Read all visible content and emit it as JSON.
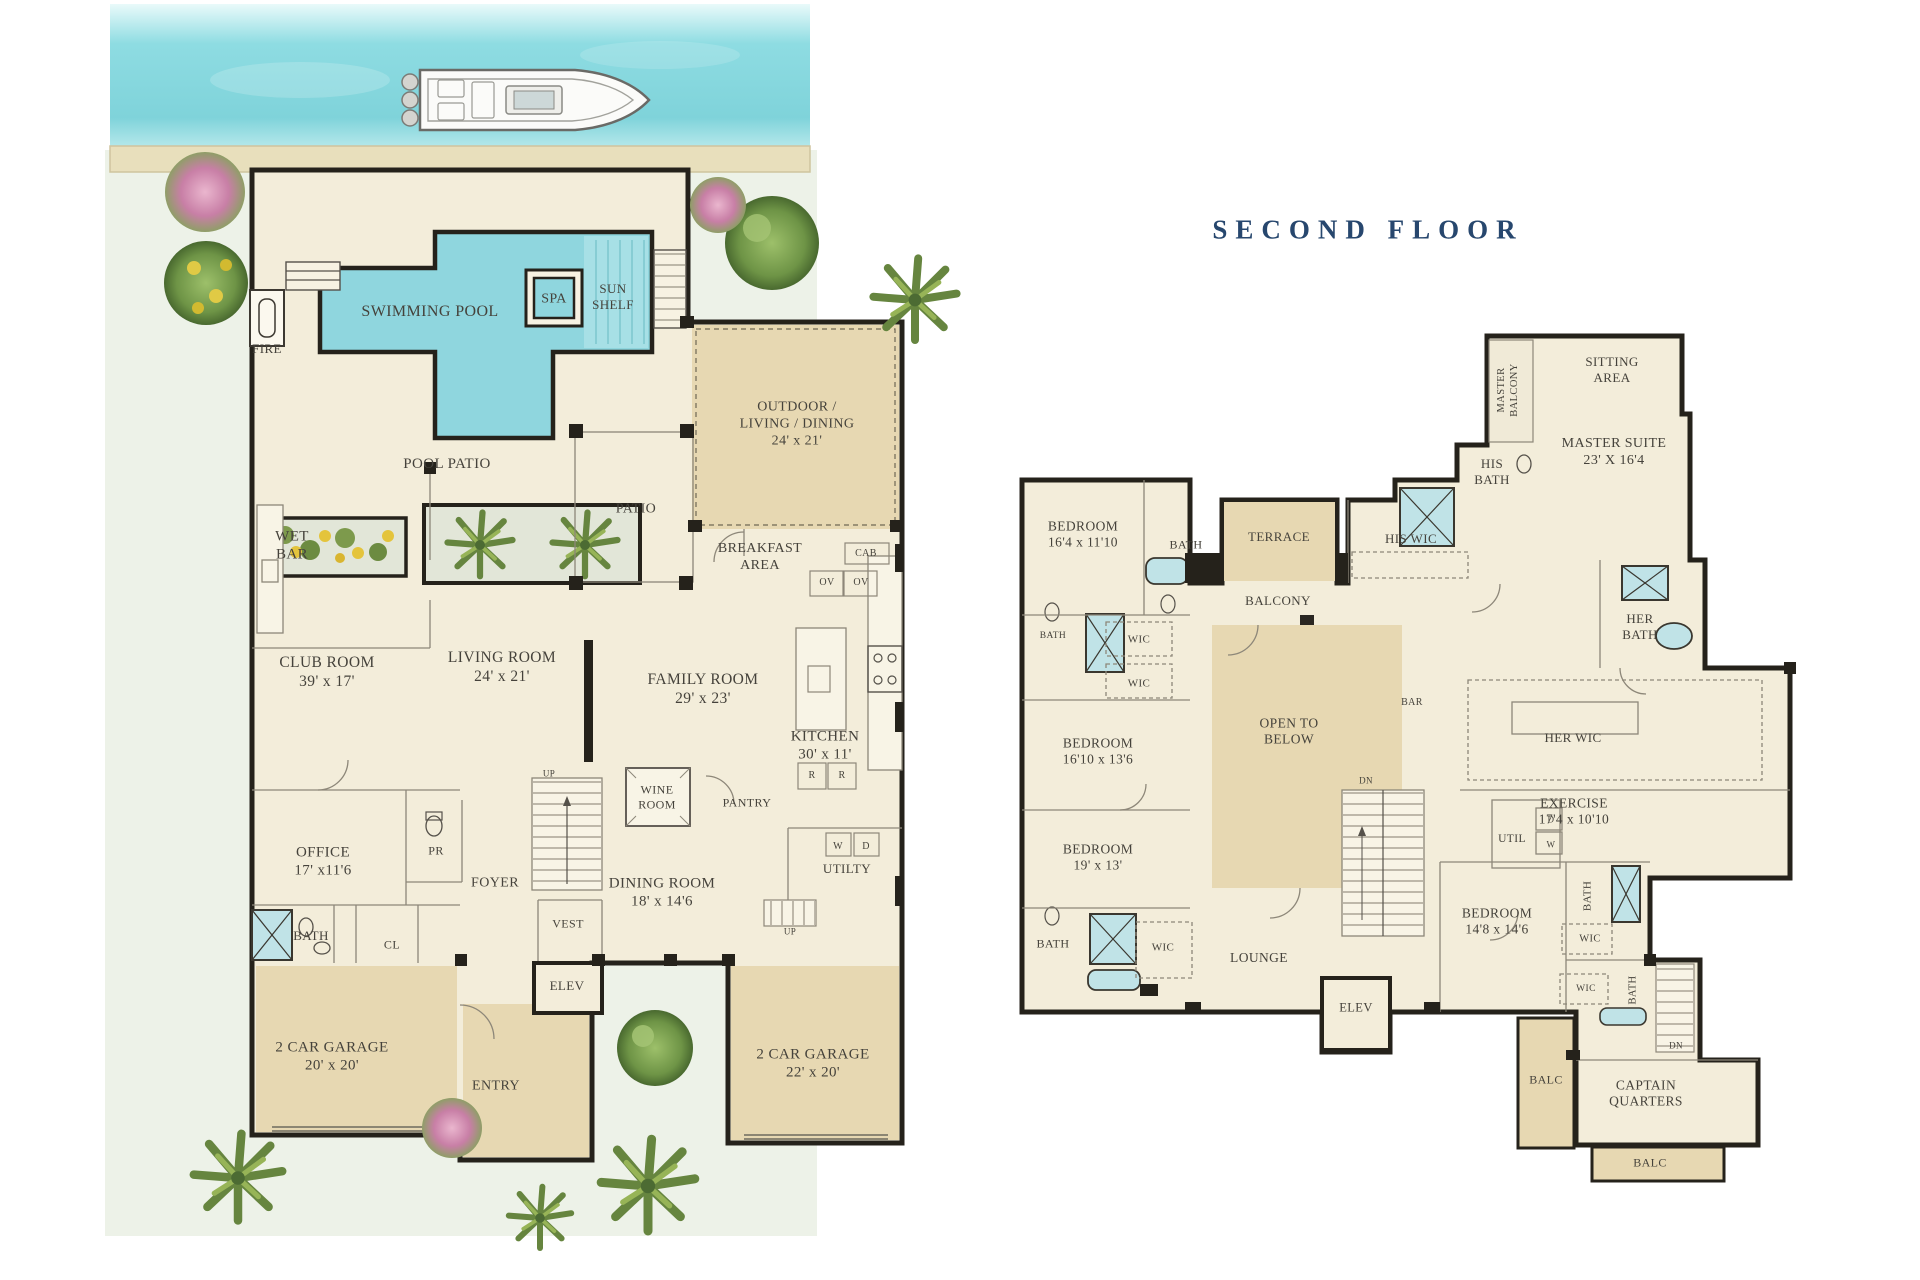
{
  "second_floor_title": {
    "text": "SECOND FLOOR",
    "color": "#27476e"
  },
  "palette": {
    "wall": "#25221b",
    "cream": "#f3edda",
    "tan": "#e7d8b2",
    "pool": "#8fd6de",
    "fixture_blue": "#c0e3e7",
    "lawn": "#edf2e8",
    "water": "#8adae0",
    "dock": "#e8dfbc",
    "label": "#45423b",
    "thin_line": "#8d8779",
    "navy": "#27476e"
  },
  "first_floor": {
    "labels": [
      {
        "id": "fire",
        "lines": [
          "FIRE"
        ],
        "x": 267,
        "y": 349,
        "fs": 13
      },
      {
        "id": "swimming-pool",
        "lines": [
          "SWIMMING POOL"
        ],
        "x": 430,
        "y": 312,
        "fs": 16
      },
      {
        "id": "spa",
        "lines": [
          "SPA"
        ],
        "x": 554,
        "y": 299,
        "fs": 14
      },
      {
        "id": "sun-shelf",
        "lines": [
          "SUN",
          "SHELF"
        ],
        "x": 613,
        "y": 297,
        "fs": 13
      },
      {
        "id": "pool-patio",
        "lines": [
          "POOL PATIO"
        ],
        "x": 447,
        "y": 464,
        "fs": 15
      },
      {
        "id": "outdoor-living-dining",
        "lines": [
          "OUTDOOR /",
          "LIVING / DINING",
          "24' x 21'"
        ],
        "x": 797,
        "y": 424,
        "fs": 14
      },
      {
        "id": "patio",
        "lines": [
          "PATIO"
        ],
        "x": 636,
        "y": 509,
        "fs": 14
      },
      {
        "id": "wet-bar",
        "lines": [
          "WET",
          "BAR"
        ],
        "x": 292,
        "y": 546,
        "fs": 15
      },
      {
        "id": "breakfast-area",
        "lines": [
          "BREAKFAST",
          "AREA"
        ],
        "x": 760,
        "y": 557,
        "fs": 14
      },
      {
        "id": "cab",
        "lines": [
          "CAB"
        ],
        "x": 866,
        "y": 554,
        "fs": 10
      },
      {
        "id": "oven-left",
        "lines": [
          "OV"
        ],
        "x": 827,
        "y": 583,
        "fs": 10
      },
      {
        "id": "oven-right",
        "lines": [
          "OV"
        ],
        "x": 861,
        "y": 583,
        "fs": 10
      },
      {
        "id": "club-room",
        "lines": [
          "CLUB ROOM",
          "39' x 17'"
        ],
        "x": 327,
        "y": 673,
        "fs": 15.5
      },
      {
        "id": "living-room",
        "lines": [
          "LIVING ROOM",
          "24' x 21'"
        ],
        "x": 502,
        "y": 668,
        "fs": 15.5
      },
      {
        "id": "family-room",
        "lines": [
          "FAMILY ROOM",
          "29' x 23'"
        ],
        "x": 703,
        "y": 690,
        "fs": 15.5
      },
      {
        "id": "kitchen",
        "lines": [
          "KITCHEN",
          "30' x 11'"
        ],
        "x": 825,
        "y": 746,
        "fs": 15
      },
      {
        "id": "range-left",
        "lines": [
          "R"
        ],
        "x": 812,
        "y": 776,
        "fs": 10
      },
      {
        "id": "range-right",
        "lines": [
          "R"
        ],
        "x": 842,
        "y": 776,
        "fs": 10
      },
      {
        "id": "wine-room",
        "lines": [
          "WINE",
          "ROOM"
        ],
        "x": 657,
        "y": 797,
        "fs": 12
      },
      {
        "id": "pantry",
        "lines": [
          "PANTRY"
        ],
        "x": 747,
        "y": 803,
        "fs": 12
      },
      {
        "id": "stairs-up-foyer",
        "lines": [
          "UP"
        ],
        "x": 549,
        "y": 774,
        "fs": 9
      },
      {
        "id": "office",
        "lines": [
          "OFFICE",
          "17' x11'6"
        ],
        "x": 323,
        "y": 862,
        "fs": 15
      },
      {
        "id": "powder-room",
        "lines": [
          "PR"
        ],
        "x": 436,
        "y": 851,
        "fs": 12
      },
      {
        "id": "foyer",
        "lines": [
          "FOYER"
        ],
        "x": 495,
        "y": 883,
        "fs": 14
      },
      {
        "id": "dining-room",
        "lines": [
          "DINING ROOM",
          "18' x 14'6"
        ],
        "x": 662,
        "y": 893,
        "fs": 15
      },
      {
        "id": "vestibule",
        "lines": [
          "VEST"
        ],
        "x": 568,
        "y": 924,
        "fs": 12
      },
      {
        "id": "bath",
        "lines": [
          "BATH"
        ],
        "x": 311,
        "y": 936,
        "fs": 13
      },
      {
        "id": "closet",
        "lines": [
          "CL"
        ],
        "x": 392,
        "y": 945,
        "fs": 12
      },
      {
        "id": "elevator",
        "lines": [
          "ELEV"
        ],
        "x": 567,
        "y": 986,
        "fs": 13
      },
      {
        "id": "washer",
        "lines": [
          "W"
        ],
        "x": 838,
        "y": 847,
        "fs": 10
      },
      {
        "id": "dryer",
        "lines": [
          "D"
        ],
        "x": 866,
        "y": 847,
        "fs": 10
      },
      {
        "id": "utility",
        "lines": [
          "UTILTY"
        ],
        "x": 847,
        "y": 869,
        "fs": 13
      },
      {
        "id": "stairs-up-garage",
        "lines": [
          "UP"
        ],
        "x": 790,
        "y": 932,
        "fs": 9
      },
      {
        "id": "garage-left",
        "lines": [
          "2 CAR GARAGE",
          "20' x 20'"
        ],
        "x": 332,
        "y": 1057,
        "fs": 15
      },
      {
        "id": "entry",
        "lines": [
          "ENTRY"
        ],
        "x": 496,
        "y": 1086,
        "fs": 14
      },
      {
        "id": "garage-right",
        "lines": [
          "2 CAR GARAGE",
          "22' x 20'"
        ],
        "x": 813,
        "y": 1064,
        "fs": 15
      }
    ]
  },
  "second_floor": {
    "labels": [
      {
        "id": "master-balcony",
        "lines": [
          "MASTER",
          "BALCONY"
        ],
        "x": 1509,
        "y": 390,
        "fs": 10.5,
        "rot": 1
      },
      {
        "id": "sitting-area",
        "lines": [
          "SITTING",
          "AREA"
        ],
        "x": 1612,
        "y": 370,
        "fs": 13
      },
      {
        "id": "master-suite",
        "lines": [
          "MASTER SUITE",
          "23' X 16'4"
        ],
        "x": 1614,
        "y": 452,
        "fs": 14
      },
      {
        "id": "his-bath",
        "lines": [
          "HIS",
          "BATH"
        ],
        "x": 1492,
        "y": 472,
        "fs": 13
      },
      {
        "id": "bedroom-1",
        "lines": [
          "BEDROOM",
          "16'4 x 11'10"
        ],
        "x": 1083,
        "y": 535,
        "fs": 13.5
      },
      {
        "id": "bath-1",
        "lines": [
          "BATH"
        ],
        "x": 1186,
        "y": 545,
        "fs": 12
      },
      {
        "id": "terrace",
        "lines": [
          "TERRACE"
        ],
        "x": 1279,
        "y": 537,
        "fs": 13
      },
      {
        "id": "his-wic",
        "lines": [
          "HIS WIC"
        ],
        "x": 1411,
        "y": 539,
        "fs": 13
      },
      {
        "id": "balcony",
        "lines": [
          "BALCONY"
        ],
        "x": 1278,
        "y": 601,
        "fs": 13
      },
      {
        "id": "her-bath",
        "lines": [
          "HER",
          "BATH"
        ],
        "x": 1640,
        "y": 627,
        "fs": 13
      },
      {
        "id": "bath-2",
        "lines": [
          "BATH"
        ],
        "x": 1053,
        "y": 637,
        "fs": 9.5
      },
      {
        "id": "wic-1",
        "lines": [
          "WIC"
        ],
        "x": 1139,
        "y": 640,
        "fs": 11
      },
      {
        "id": "wic-2",
        "lines": [
          "WIC"
        ],
        "x": 1139,
        "y": 684,
        "fs": 11
      },
      {
        "id": "open-to-below",
        "lines": [
          "OPEN TO",
          "BELOW"
        ],
        "x": 1289,
        "y": 732,
        "fs": 13.5
      },
      {
        "id": "bar",
        "lines": [
          "BAR"
        ],
        "x": 1412,
        "y": 703,
        "fs": 10
      },
      {
        "id": "her-wic",
        "lines": [
          "HER WIC"
        ],
        "x": 1573,
        "y": 738,
        "fs": 13
      },
      {
        "id": "bedroom-2",
        "lines": [
          "BEDROOM",
          "16'10 x 13'6"
        ],
        "x": 1098,
        "y": 752,
        "fs": 13.5
      },
      {
        "id": "stairs-dn",
        "lines": [
          "DN"
        ],
        "x": 1366,
        "y": 781,
        "fs": 9
      },
      {
        "id": "exercise",
        "lines": [
          "EXERCISE",
          "17'4 x 10'10"
        ],
        "x": 1574,
        "y": 812,
        "fs": 13.5
      },
      {
        "id": "util",
        "lines": [
          "UTIL"
        ],
        "x": 1512,
        "y": 839,
        "fs": 11.5
      },
      {
        "id": "dryer-2",
        "lines": [
          "D"
        ],
        "x": 1551,
        "y": 820,
        "fs": 9
      },
      {
        "id": "washer-2",
        "lines": [
          "W"
        ],
        "x": 1551,
        "y": 845,
        "fs": 9
      },
      {
        "id": "bedroom-3",
        "lines": [
          "BEDROOM",
          "19' x 13'"
        ],
        "x": 1098,
        "y": 858,
        "fs": 13.5
      },
      {
        "id": "bedroom-4",
        "lines": [
          "BEDROOM",
          "14'8 x 14'6"
        ],
        "x": 1497,
        "y": 922,
        "fs": 13.5
      },
      {
        "id": "bath-3",
        "lines": [
          "BATH"
        ],
        "x": 1588,
        "y": 896,
        "fs": 11,
        "rot": 1
      },
      {
        "id": "bath-4",
        "lines": [
          "BATH"
        ],
        "x": 1053,
        "y": 944,
        "fs": 12
      },
      {
        "id": "wic-bl",
        "lines": [
          "WIC"
        ],
        "x": 1163,
        "y": 948,
        "fs": 11
      },
      {
        "id": "lounge",
        "lines": [
          "LOUNGE"
        ],
        "x": 1259,
        "y": 958,
        "fs": 13.5
      },
      {
        "id": "elevator-2",
        "lines": [
          "ELEV"
        ],
        "x": 1356,
        "y": 1008,
        "fs": 12.5
      },
      {
        "id": "wic-3",
        "lines": [
          "WIC"
        ],
        "x": 1590,
        "y": 940,
        "fs": 10.5
      },
      {
        "id": "wic-4",
        "lines": [
          "WIC"
        ],
        "x": 1586,
        "y": 990,
        "fs": 9.5
      },
      {
        "id": "bath-5",
        "lines": [
          "BATH"
        ],
        "x": 1634,
        "y": 990,
        "fs": 10.5,
        "rot": 1
      },
      {
        "id": "stairs-dn-captain",
        "lines": [
          "DN"
        ],
        "x": 1676,
        "y": 1046,
        "fs": 9
      },
      {
        "id": "balc-left",
        "lines": [
          "BALC"
        ],
        "x": 1546,
        "y": 1080,
        "fs": 12
      },
      {
        "id": "captain-quarters",
        "lines": [
          "CAPTAIN",
          "QUARTERS"
        ],
        "x": 1646,
        "y": 1094,
        "fs": 13.5
      },
      {
        "id": "balc-bottom",
        "lines": [
          "BALC"
        ],
        "x": 1650,
        "y": 1163,
        "fs": 12
      }
    ]
  }
}
